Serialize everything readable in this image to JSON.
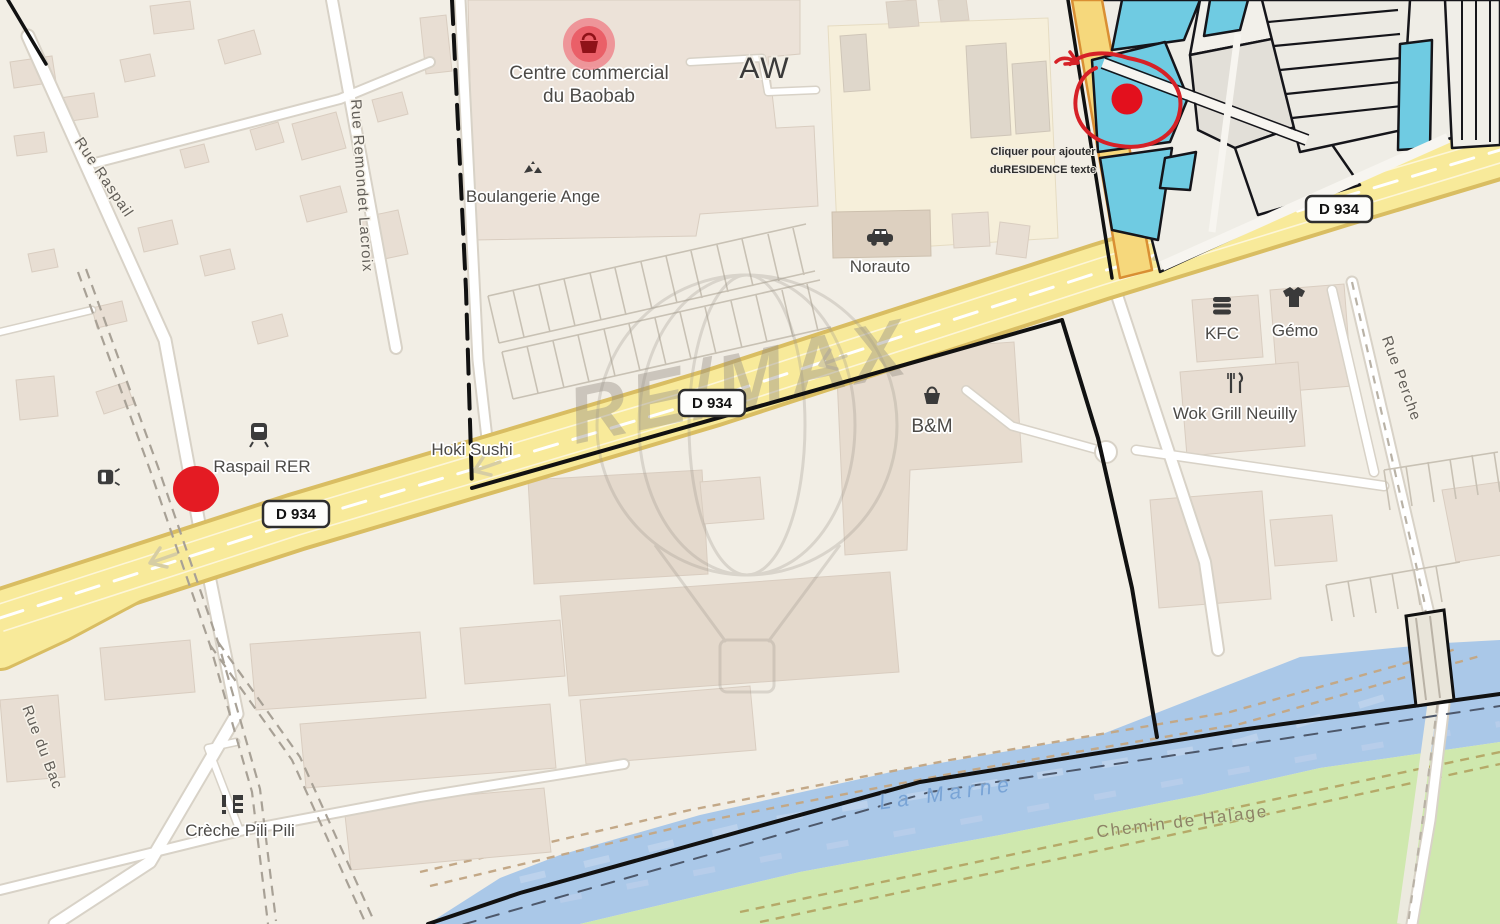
{
  "watermark": "RE/MAX",
  "road_shield": "D 934",
  "note": {
    "line1": "Cliquer pour ajouter",
    "line2": "duRESIDENCE texte"
  },
  "streets": {
    "rue_raspail": "Rue Raspail",
    "rue_remondet_lacroix": "Rue Remondet Lacroix",
    "rue_du_bac": "Rue du Bac",
    "rue_perche": "Rue Perche",
    "chemin_de_halage": "Chemin de Halage"
  },
  "water": {
    "la_marne": "La Marne"
  },
  "pois": {
    "centre_commercial_line1": "Centre commercial",
    "centre_commercial_line2": "du Baobab",
    "aw": "AW",
    "boulangerie": "Boulangerie Ange",
    "norauto": "Norauto",
    "hoki_sushi": "Hoki Sushi",
    "raspail_rer": "Raspail RER",
    "kfc": "KFC",
    "gemo": "Gémo",
    "wok_grill": "Wok Grill Neuilly",
    "bm": "B&M",
    "creche": "Crèche Pili Pili"
  },
  "colors": {
    "background": "#f2eee5",
    "road_primary": "#f8ea9a",
    "water": "#aac8e8",
    "grass": "#cfe8ae",
    "parcel_highlight": "#6fcbe2",
    "annotation_red": "#dd1a24",
    "marker_pink": "#ef8289",
    "boundary_black": "#111111"
  }
}
